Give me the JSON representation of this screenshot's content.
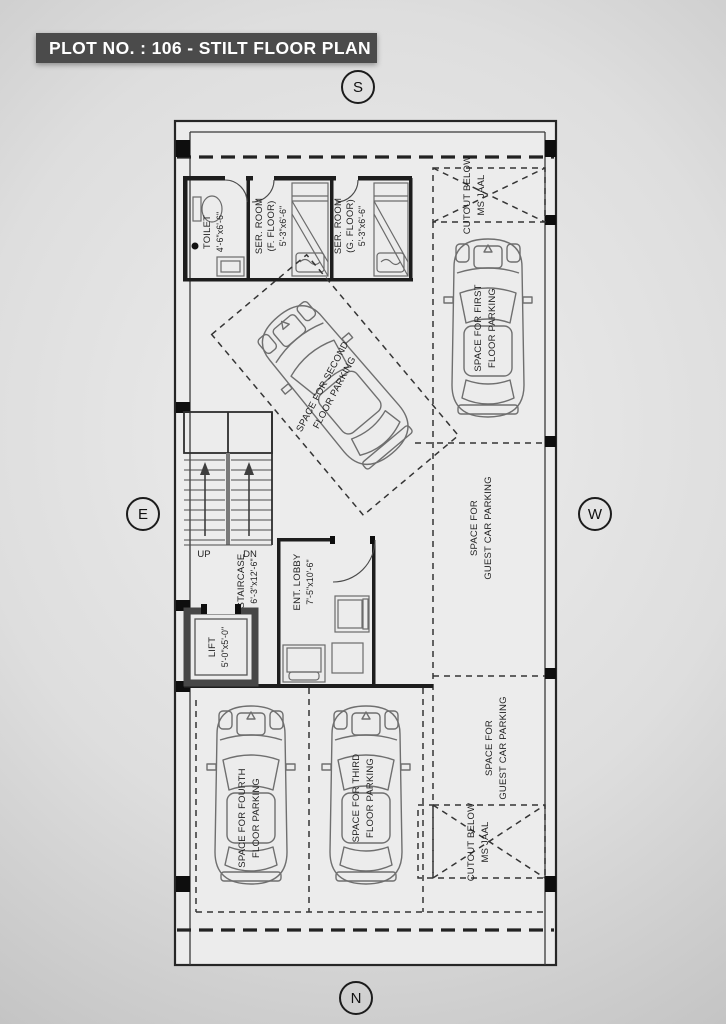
{
  "title": "PLOT NO. : 106 - STILT FLOOR PLAN",
  "compass": {
    "top": "S",
    "left": "E",
    "right": "W",
    "bottom": "N"
  },
  "rooms": {
    "toilet": {
      "name": "TOILET",
      "dims": "4'-6\"x6'-6\""
    },
    "ser_room_f": {
      "name": "SER. ROOM",
      "floor": "(F. FLOOR)",
      "dims": "5'-3\"x6'-6\""
    },
    "ser_room_g": {
      "name": "SER. ROOM",
      "floor": "(G. FLOOR)",
      "dims": "5'-3\"x6'-6\""
    },
    "staircase": {
      "name": "STAIRCASE",
      "dims": "6'-3\"x12'-6\"",
      "up": "UP",
      "down": "DN"
    },
    "lobby": {
      "name": "ENT. LOBBY",
      "dims": "7'-5\"x10'-6\""
    },
    "lift": {
      "name": "LIFT",
      "dims": "5'-0\"x5'-0\""
    }
  },
  "parking": {
    "first": {
      "line1": "SPACE FOR FIRST",
      "line2": "FLOOR PARKING"
    },
    "second": {
      "line1": "SPACE FOR SECOND",
      "line2": "FLOOR PARKING"
    },
    "third": {
      "line1": "SPACE FOR THIRD",
      "line2": "FLOOR PARKING"
    },
    "fourth": {
      "line1": "SPACE FOR FOURTH",
      "line2": "FLOOR PARKING"
    },
    "guest_upper": {
      "line1": "SPACE FOR",
      "line2": "GUEST CAR PARKING"
    },
    "guest_lower": {
      "line1": "SPACE FOR",
      "line2": "GUEST CAR PARKING"
    }
  },
  "cutouts": {
    "top": {
      "line1": "CUTOUT BELOW",
      "line2": "MS JAAL"
    },
    "bottom": {
      "line1": "CUTOUT BELOW",
      "line2": "MS JAAL"
    }
  },
  "colors": {
    "title_bar": "#4b4b4b",
    "line": "#2a2a2a",
    "background_center": "#eeeeee",
    "background_edge": "#a8a8a8"
  }
}
